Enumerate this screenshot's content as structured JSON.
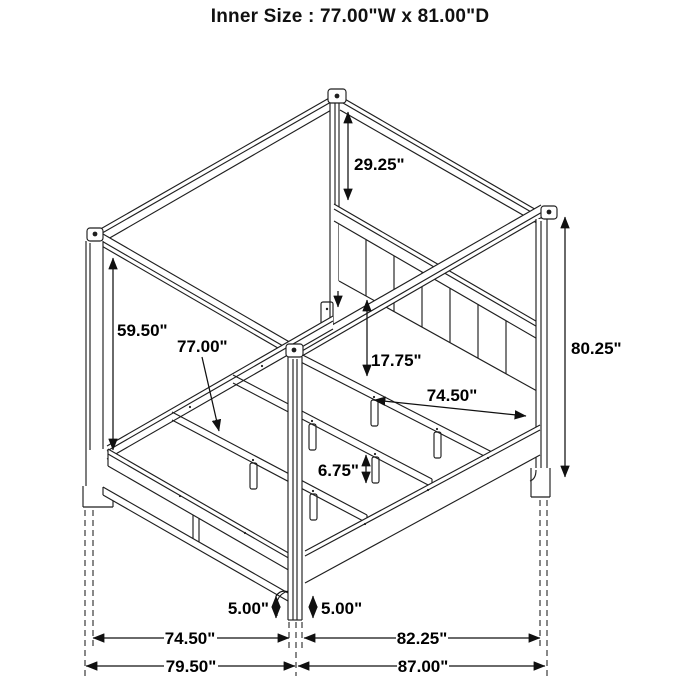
{
  "title": "Inner Size : 77.00\"W x 81.00\"D",
  "dimensions": {
    "canopy_to_headboard": "29.25\"",
    "left_post_inner_height": "59.50\"",
    "slat_width": "77.00\"",
    "headboard_bottom_to_rail": "17.75\"",
    "side_rail_length": "74.50\"",
    "overall_height": "80.25\"",
    "slat_leg_height": "6.75\"",
    "footboard_floor_clearance": "5.00\"",
    "siderail_floor_clearance": "5.00\"",
    "front_width_inner": "74.50\"",
    "side_depth_inner": "82.25\"",
    "front_width_overall": "79.50\"",
    "side_depth_overall": "87.00\""
  },
  "colors": {
    "line": "#1f1f1f",
    "background": "#ffffff"
  }
}
